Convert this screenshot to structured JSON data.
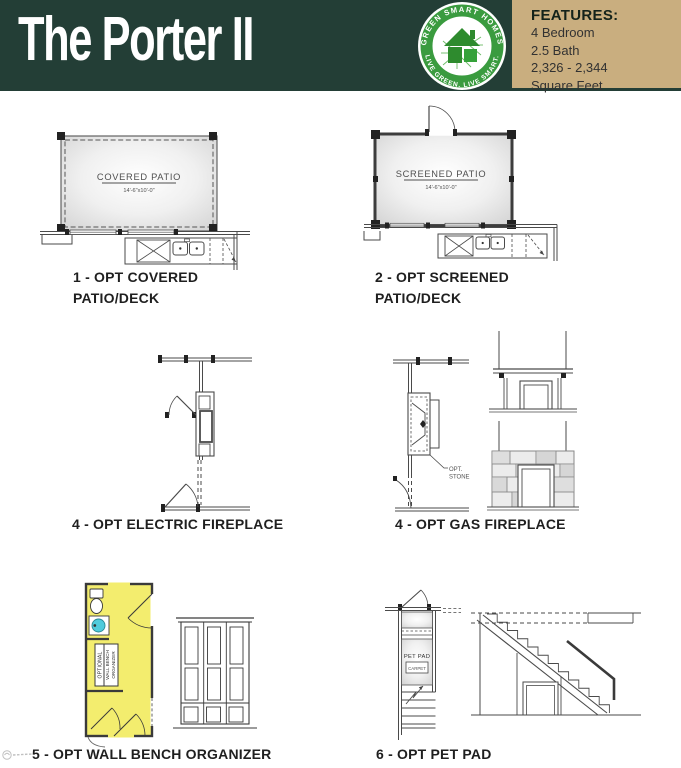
{
  "header": {
    "title": "The Porter II",
    "logo": {
      "arc_top": "GREEN SMART HOMES",
      "arc_bottom": "LIVE GREEN. LIVE SMART."
    },
    "features": {
      "heading": "FEATURES:",
      "line1": "4 Bedroom",
      "line2": "2.5 Bath",
      "line3": "2,326 - 2,344",
      "line4": "Square Feet"
    }
  },
  "plans": {
    "covered_patio": {
      "room_label": "COVERED PATIO",
      "room_dims": "14'-6\"x10'-0\"",
      "caption1": "1 - OPT COVERED",
      "caption2": "PATIO/DECK"
    },
    "screened_patio": {
      "room_label": "SCREENED PATIO",
      "room_dims": "14'-6\"x10'-0\"",
      "caption1": "2 - OPT SCREENED",
      "caption2": "PATIO/DECK"
    },
    "electric_fireplace": {
      "caption": "4 - OPT ELECTRIC FIREPLACE"
    },
    "gas_fireplace": {
      "caption": "4 - OPT GAS FIREPLACE",
      "note1": "OPT.",
      "note2": "STONE"
    },
    "wall_bench": {
      "caption": "5 - OPT WALL BENCH ORGANIZER",
      "tag1": "OPTIONAL",
      "tag2": "WALL BENCH",
      "tag3": "ORGANIZER"
    },
    "pet_pad": {
      "caption": "6 - OPT PET PAD",
      "room_label": "PET PAD",
      "room_sub": "CARPET"
    }
  },
  "colors": {
    "header_green": "#233E36",
    "features_tan": "#C9AE7F",
    "logo_ring_green": "#3A9B3F",
    "logo_house_green": "#2E8B2E",
    "highlight_yellow": "#F3ED6E",
    "sink_cyan": "#4FCBDC",
    "plan_line": "#4A4A4A"
  }
}
